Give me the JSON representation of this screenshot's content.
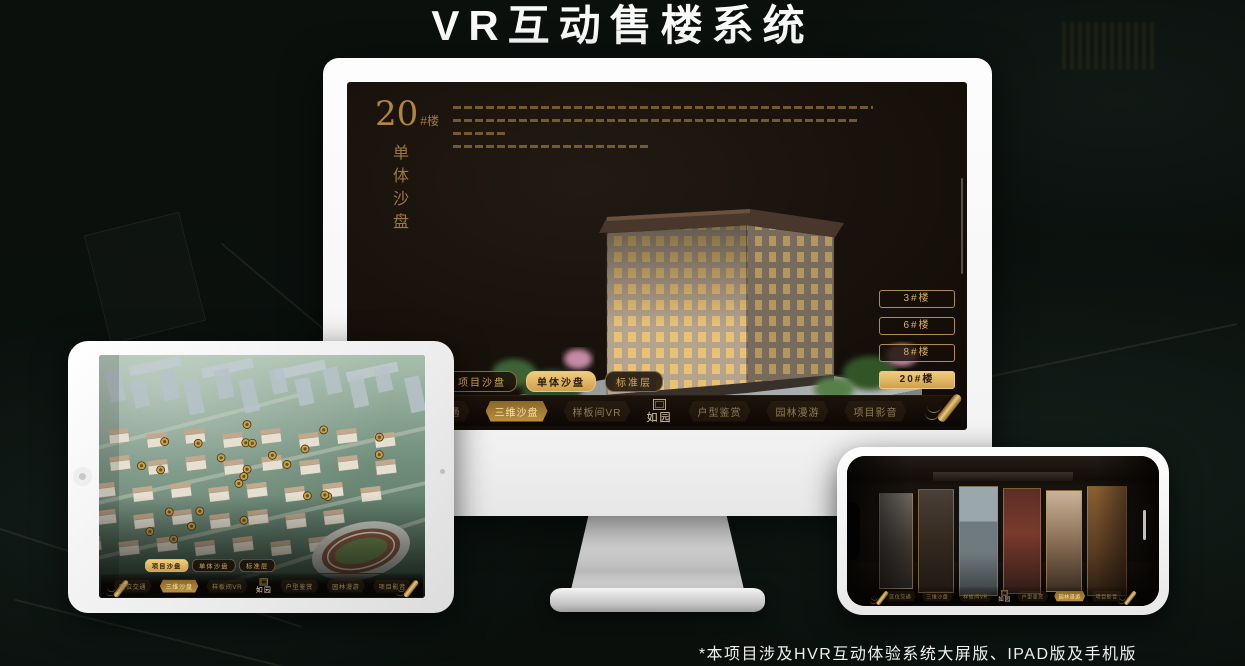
{
  "page": {
    "title": "VR互动售楼系统",
    "footnote": "*本项目涉及HVR互动体验系统大屏版、IPAD版及手机版"
  },
  "sandbox": {
    "building_no": "20",
    "building_unit": "#楼",
    "building_mode": "单体沙盘",
    "view_tabs": [
      "项目沙盘",
      "单体沙盘",
      "标准层"
    ],
    "floor_buttons": [
      "3#楼",
      "6#楼",
      "8#楼",
      "20#楼"
    ]
  },
  "nav": {
    "items": [
      "区位交通",
      "三维沙盘",
      "样板间VR",
      "户型鉴赏",
      "园林漫游",
      "项目影音"
    ],
    "logo": "如园"
  },
  "active_state": {
    "monitor_view_tab": "单体沙盘",
    "tablet_view_tab": "项目沙盘",
    "floor_button": "20#楼",
    "monitor_nav_item": "三维沙盘",
    "tablet_nav_item": "三维沙盘",
    "phone_nav_item": "园林漫游"
  },
  "colors": {
    "gold": "#cfa04c",
    "gold_bright": "#f0cd7e",
    "screen_bg": "#140e09",
    "page_bg": "#0b100d"
  }
}
